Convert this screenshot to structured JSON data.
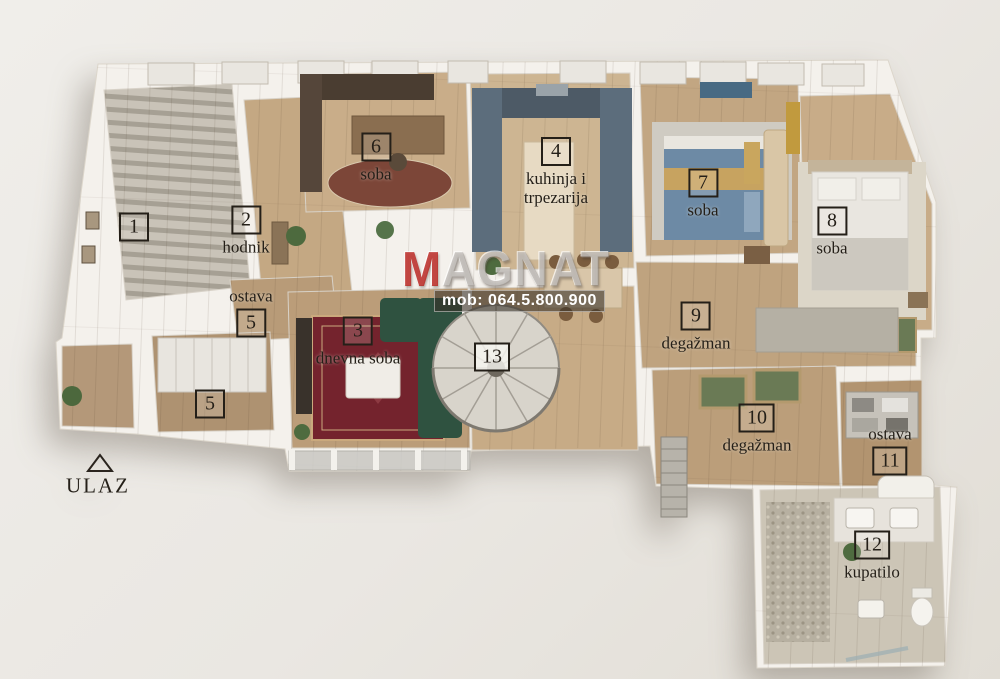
{
  "title": "3D floor plan (apartment)",
  "entrance": {
    "label": "ULAZ"
  },
  "watermark": {
    "brand_initial": "M",
    "brand_rest": "AGNAT",
    "phone": "mob: 064.5.800.900",
    "brand_accent_color": "#ba2925"
  },
  "rooms": [
    {
      "number": "1",
      "name": ""
    },
    {
      "number": "2",
      "name": "hodnik"
    },
    {
      "number": "3",
      "name": "dnevna soba"
    },
    {
      "number": "4",
      "name": "kuhinja i trpezarija"
    },
    {
      "number": "5",
      "name": "ostava"
    },
    {
      "number": "5",
      "name": ""
    },
    {
      "number": "6",
      "name": "soba"
    },
    {
      "number": "7",
      "name": "soba"
    },
    {
      "number": "8",
      "name": "soba"
    },
    {
      "number": "9",
      "name": "degažman"
    },
    {
      "number": "10",
      "name": "degažman"
    },
    {
      "number": "11",
      "name": "ostava"
    },
    {
      "number": "12",
      "name": "kupatilo"
    },
    {
      "number": "13",
      "name": ""
    }
  ],
  "colors": {
    "background": "#eae7e2",
    "walls": "#f4f1ec",
    "wood_floor": "#c2a581",
    "stairs": "#bdb7ab",
    "kitchen_cabinets": "#5c6d7c",
    "sofa_green": "#2f5240",
    "carpet_red": "#74232d",
    "bed_blue": "#6d8aa5",
    "bed_mustard": "#c7a360",
    "bathroom_tile": "#ccc5b6",
    "watermark_red": "#ba2925"
  }
}
